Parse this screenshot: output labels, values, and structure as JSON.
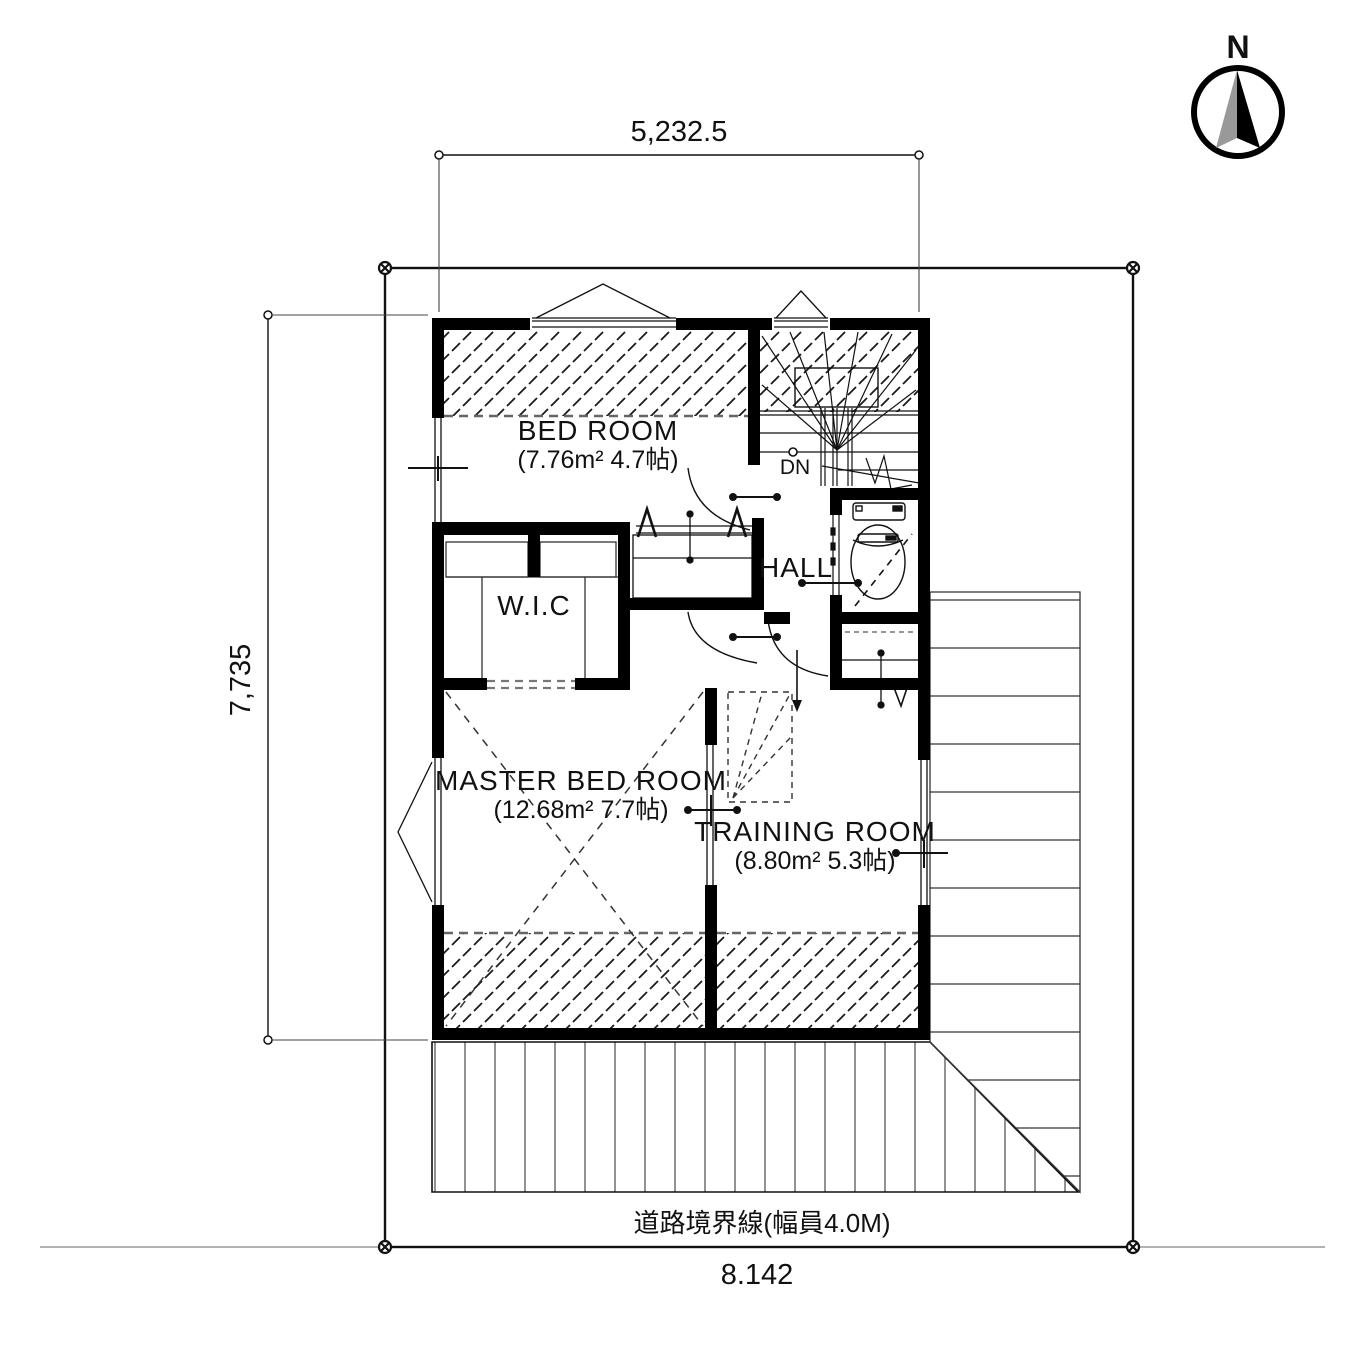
{
  "compass": {
    "label": "N"
  },
  "dimensions": {
    "top_width": "5,232.5",
    "left_height": "7,735",
    "bottom_width": "8.142",
    "road_boundary_label": "道路境界線(幅員4.0M)"
  },
  "rooms": {
    "bedroom": {
      "name": "BED ROOM",
      "area": "(7.76m² 4.7帖)"
    },
    "wic": {
      "name": "W.I.C"
    },
    "hall": {
      "name": "HALL"
    },
    "master_bedroom": {
      "name": "MASTER BED ROOM",
      "area": "(12.68m² 7.7帖)"
    },
    "training_room": {
      "name": "TRAINING ROOM",
      "area": "(8.80m² 5.3帖)"
    },
    "stairs": {
      "label": "DN"
    }
  },
  "colors": {
    "wall": "#000000",
    "hatch_line": "#1a1a1a",
    "deck_line": "#777777",
    "roof_line": "#555555",
    "dash_line": "#666666"
  }
}
